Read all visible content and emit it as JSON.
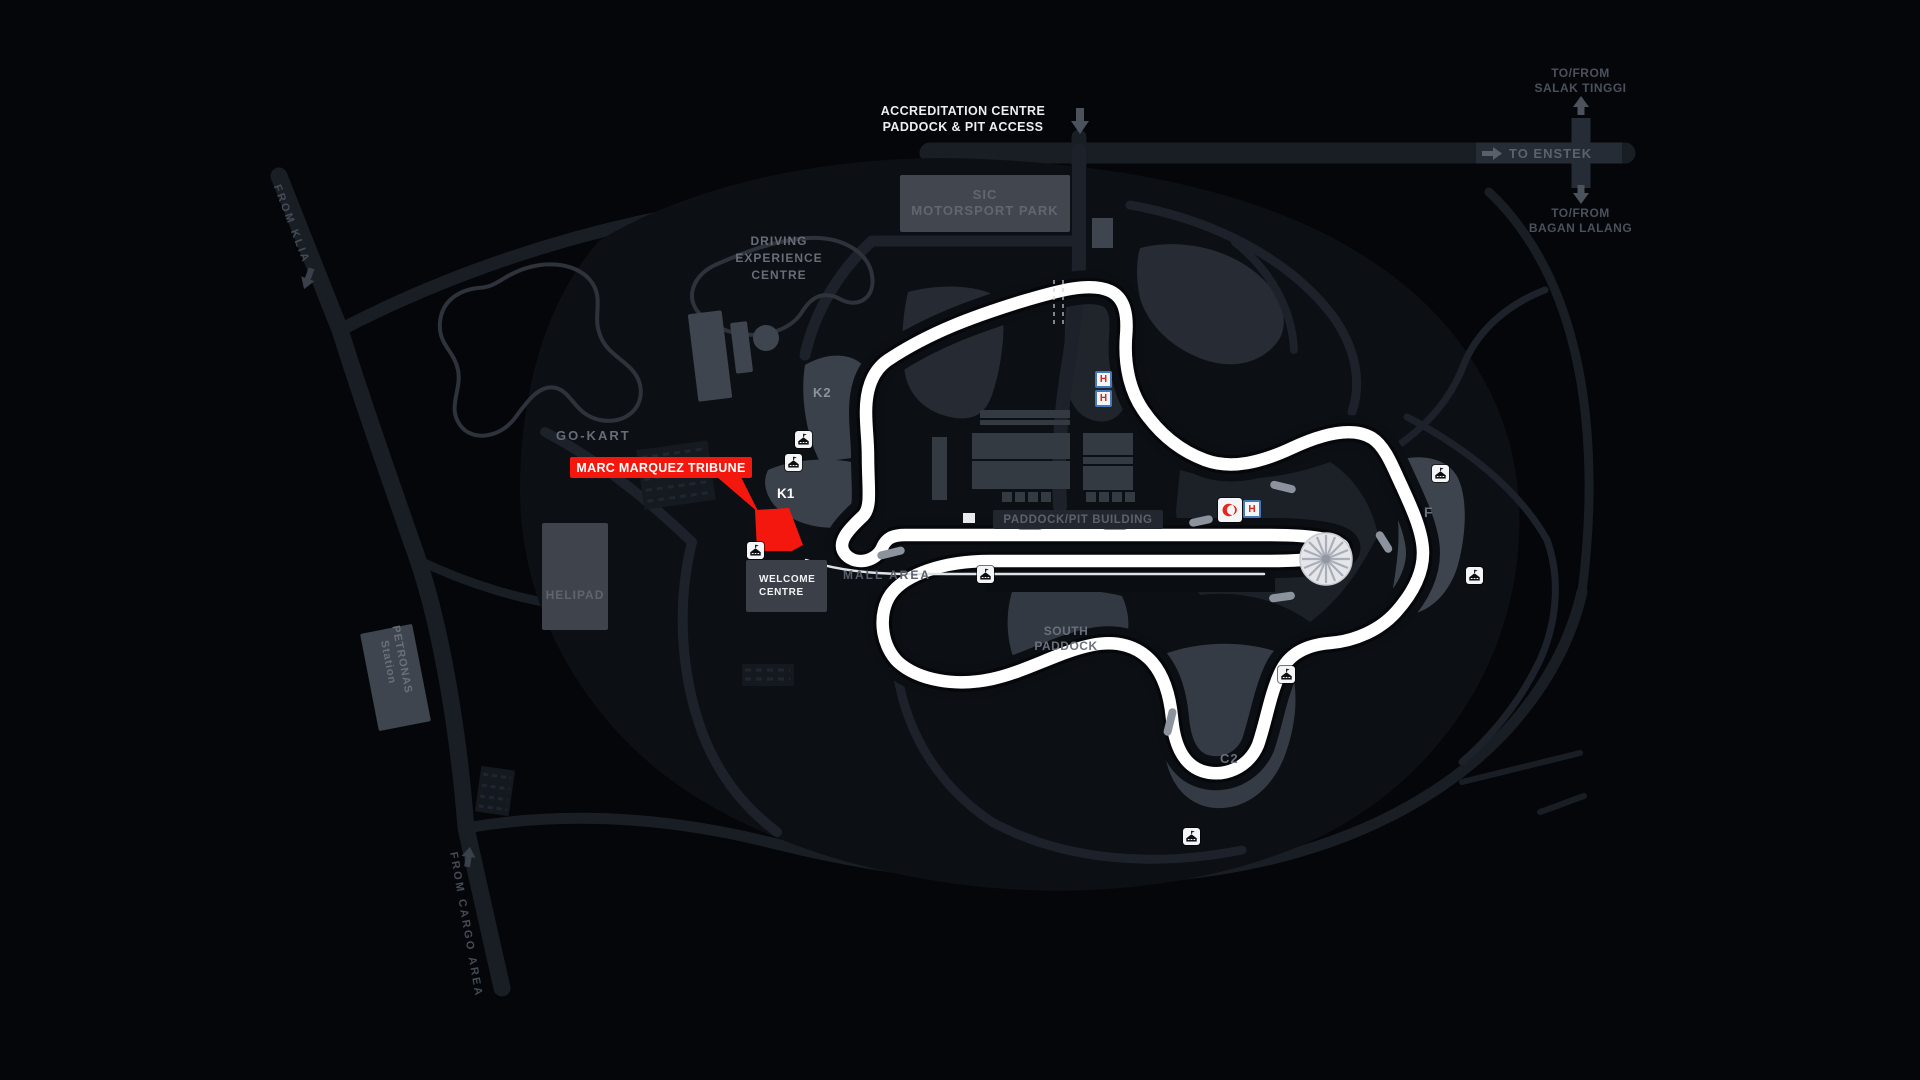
{
  "colors": {
    "background": "#04060a",
    "track_white": "#ffffff",
    "accent_red": "#f3170d",
    "zone_gray": "#3e444e",
    "road_gray": "#1b2026",
    "label_gray": "#676d77",
    "label_bright": "#eceef1",
    "medical_blue": "#4678bc",
    "medical_red": "#e02118"
  },
  "directions": {
    "accreditation_line1": "ACCREDITATION CENTRE",
    "accreditation_line2": "PADDOCK & PIT ACCESS",
    "salak_line1": "TO/FROM",
    "salak_line2": "SALAK TINGGI",
    "enstek": "TO ENSTEK",
    "bagan_line1": "TO/FROM",
    "bagan_line2": "BAGAN LALANG",
    "from_klia": "FROM KLIA",
    "from_cargo": "FROM CARGO AREA"
  },
  "facilities": {
    "sic_park_line1": "SIC",
    "sic_park_line2": "MOTORSPORT PARK",
    "driving_line1": "DRIVING",
    "driving_line2": "EXPERIENCE",
    "driving_line3": "CENTRE",
    "gokart": "GO-KART",
    "helipad": "HELIPAD",
    "petronas_line1": "PETRONAS",
    "petronas_line2": "Station",
    "welcome_line1": "WELCOME",
    "welcome_line2": "CENTRE",
    "mall": "MALL AREA",
    "paddock_pit": "PADDOCK/PIT BUILDING",
    "south_paddock_line1": "SOUTH",
    "south_paddock_line2": "PADDOCK"
  },
  "tribune": {
    "label": "MARC MARQUEZ TRIBUNE"
  },
  "sections": {
    "k1": "K1",
    "k2": "K2",
    "f": "F",
    "c2": "C2"
  },
  "markers": {
    "helipad_letter": "H"
  }
}
